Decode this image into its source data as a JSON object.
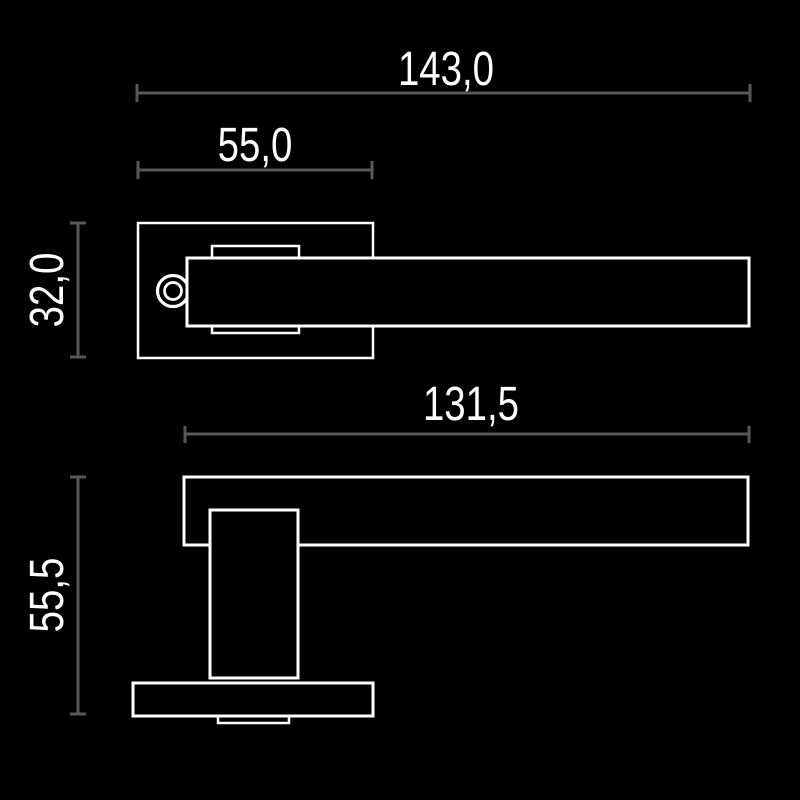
{
  "drawing": {
    "type": "technical-dimension-drawing",
    "subject": "door lever handle on square rose, two orthographic views"
  },
  "colors": {
    "background": "#000000",
    "dimension_line": "#58585b",
    "outline": "#ffffff",
    "label_text": "#ffffff"
  },
  "views": {
    "top": {
      "name": "top-view",
      "dimensions": {
        "total_length": {
          "label": "143,0",
          "value": 143.0
        },
        "rose_width": {
          "label": "55,0",
          "value": 55.0
        },
        "protrusion": {
          "label": "32,0",
          "value": 32.0
        }
      }
    },
    "front": {
      "name": "front-view",
      "dimensions": {
        "lever_length": {
          "label": "131,5",
          "value": 131.5
        },
        "total_height": {
          "label": "55,5",
          "value": 55.5
        }
      }
    }
  }
}
